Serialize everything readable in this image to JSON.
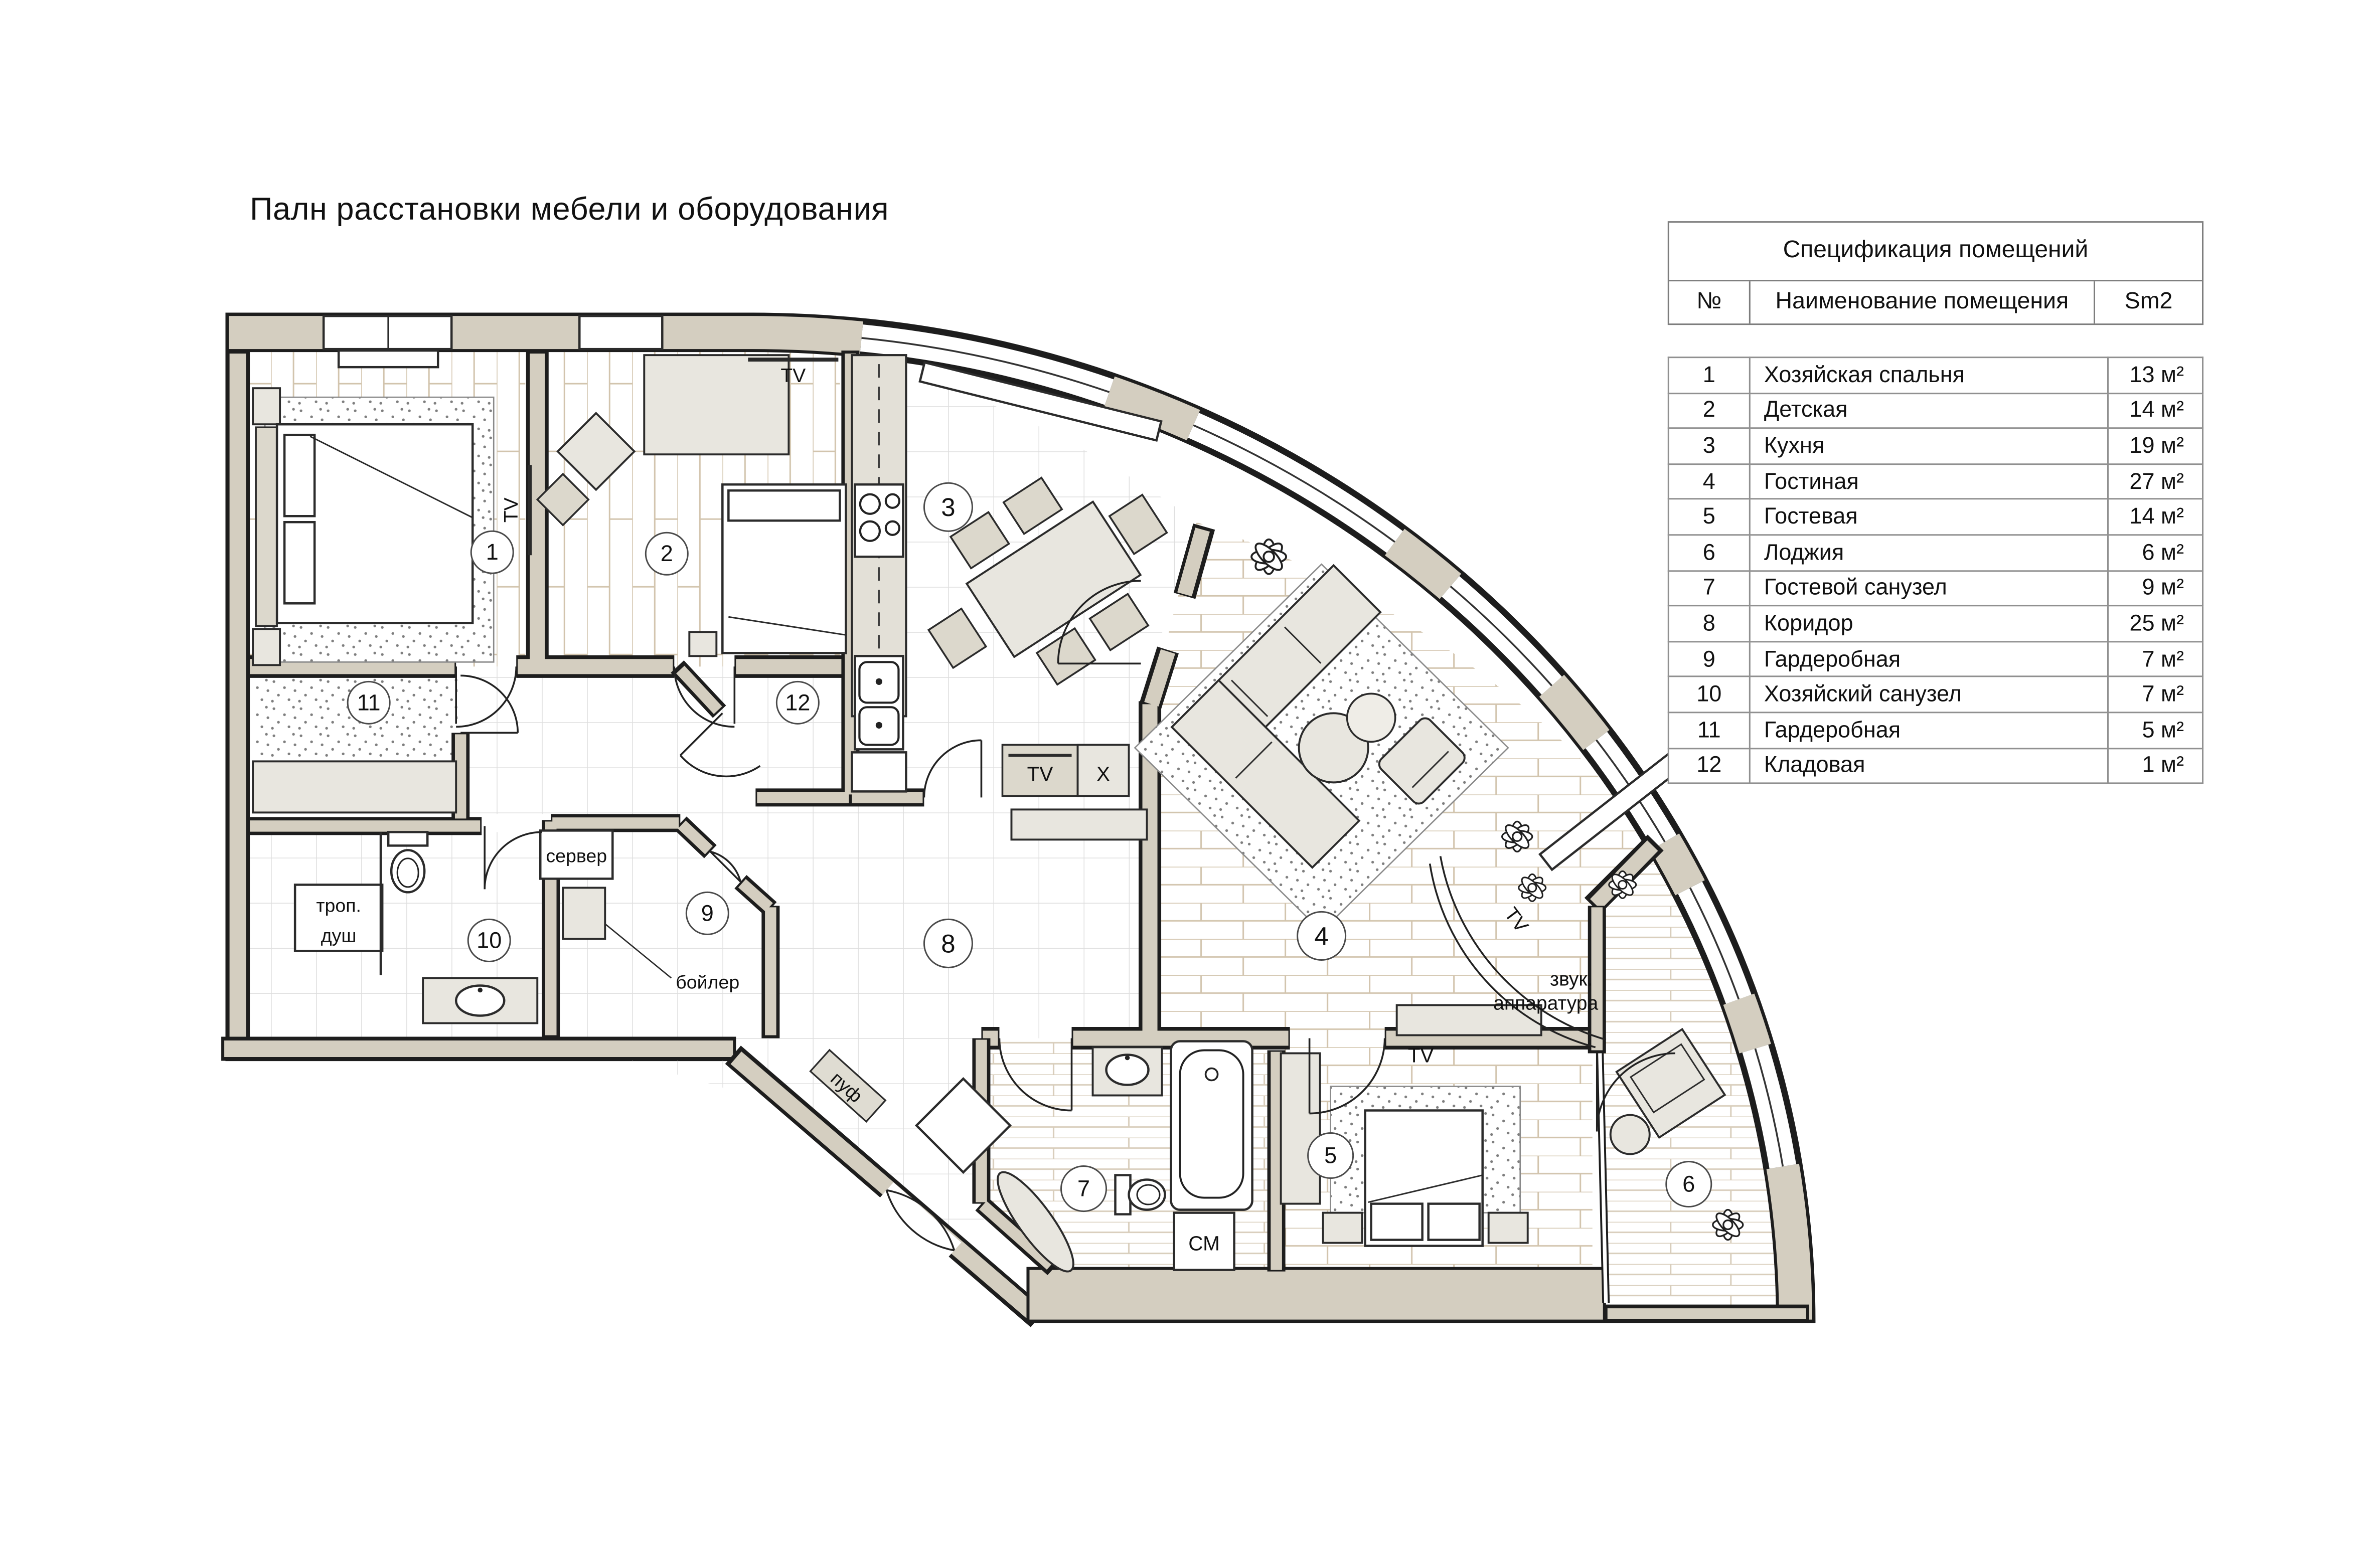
{
  "title": "Палн расстановки мебели и оборудования",
  "spec_table": {
    "title": "Спецификация помещений",
    "columns": [
      "№",
      "Наименование помещения",
      "Sm2"
    ],
    "rows": [
      {
        "num": "1",
        "name": "Хозяйская спальня",
        "area": "13 м²"
      },
      {
        "num": "2",
        "name": "Детская",
        "area": "14 м²"
      },
      {
        "num": "3",
        "name": "Кухня",
        "area": "19 м²"
      },
      {
        "num": "4",
        "name": "Гостиная",
        "area": "27 м²"
      },
      {
        "num": "5",
        "name": "Гостевая",
        "area": "14 м²"
      },
      {
        "num": "6",
        "name": "Лоджия",
        "area": "6 м²"
      },
      {
        "num": "7",
        "name": "Гостевой санузел",
        "area": "9 м²"
      },
      {
        "num": "8",
        "name": "Коридор",
        "area": "25 м²"
      },
      {
        "num": "9",
        "name": "Гардеробная",
        "area": "7 м²"
      },
      {
        "num": "10",
        "name": "Хозяйский санузел",
        "area": "7 м²"
      },
      {
        "num": "11",
        "name": "Гардеробная",
        "area": "5 м²"
      },
      {
        "num": "12",
        "name": "Кладовая",
        "area": "1 м²"
      }
    ]
  },
  "plan": {
    "room_numbers": [
      "1",
      "2",
      "3",
      "4",
      "5",
      "6",
      "7",
      "8",
      "9",
      "10",
      "11",
      "12"
    ],
    "labels": {
      "tv": "TV",
      "x": "X",
      "washer": "СМ",
      "server": "сервер",
      "boiler": "бойлер",
      "shower_line1": "троп.",
      "shower_line2": "душ",
      "pouf": "пуф",
      "audio_line1": "звук.",
      "audio_line2": "аппаратура"
    },
    "colors": {
      "wall": "#d4cec0",
      "outline": "#1d1d1d"
    }
  }
}
